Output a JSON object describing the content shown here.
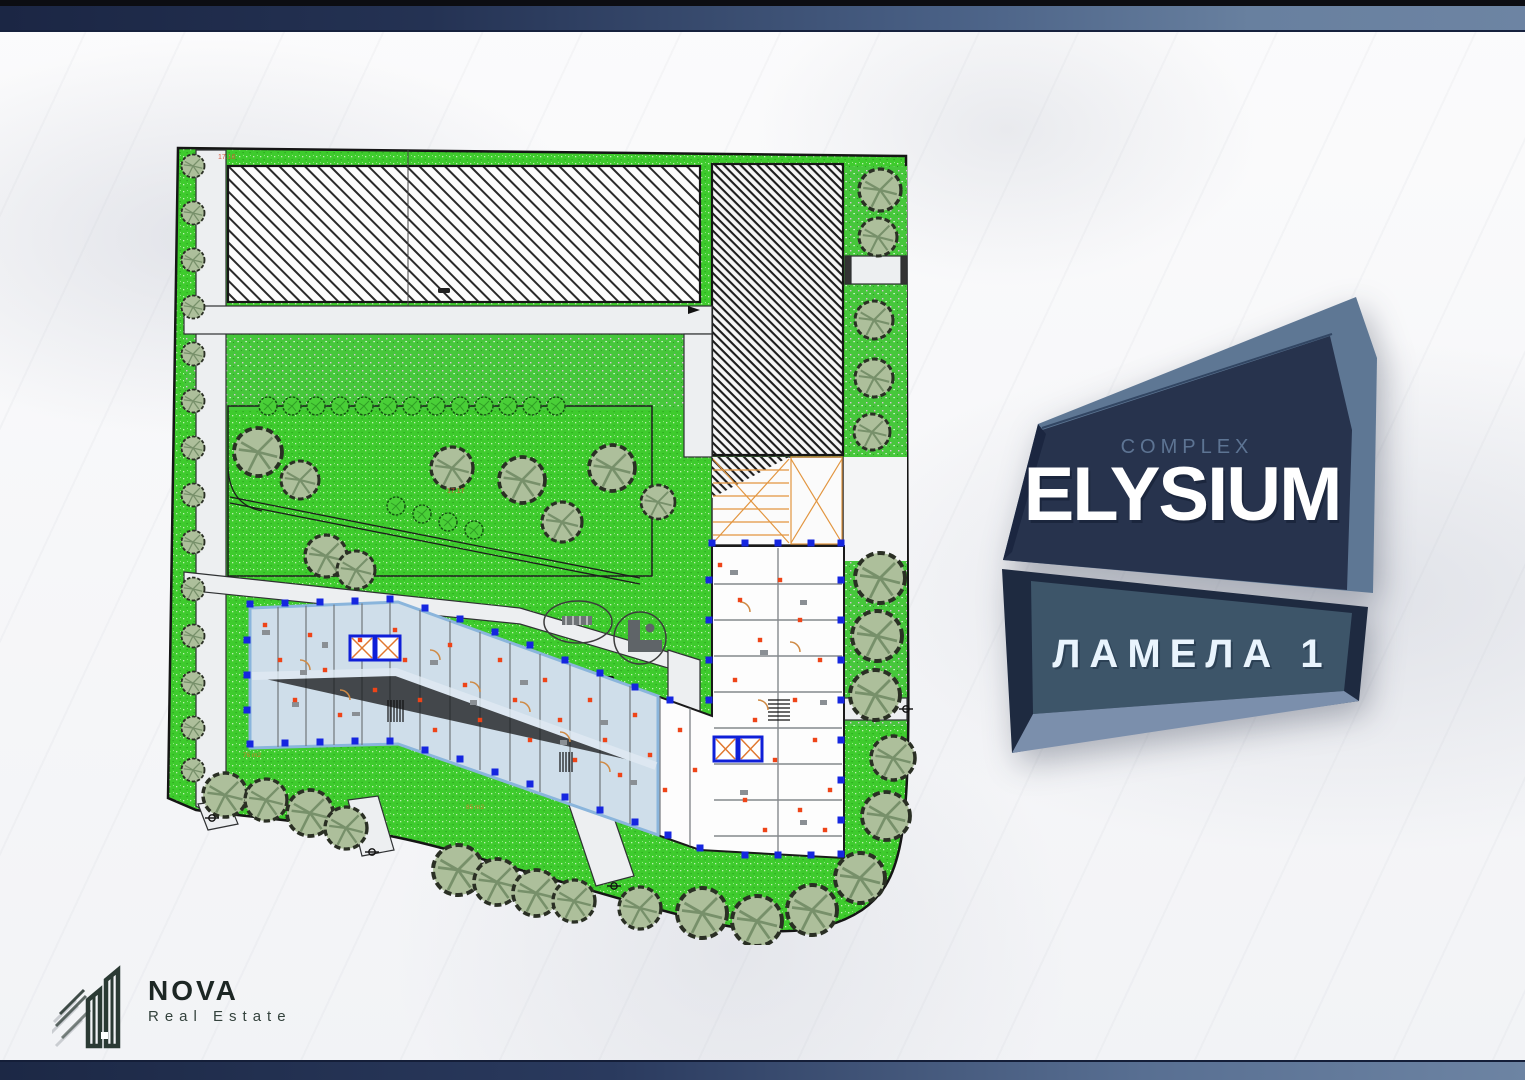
{
  "badge": {
    "kicker": "COMPLEX",
    "title": "ELYSIUM",
    "sublabel": "ЛАМЕЛА 1"
  },
  "logo": {
    "name": "NOVA",
    "tagline": "Real Estate"
  },
  "plan": {
    "labels": [
      {
        "text": "17.16"
      },
      {
        "text": "17.17"
      },
      {
        "text": "76 m2"
      },
      {
        "text": "85 m2"
      }
    ]
  },
  "colors": {
    "accent_navy": "#1e2a45",
    "accent_steel": "#6d83a4",
    "badge_face": "#27334d",
    "badge_panel": "#3d5569",
    "grass_green": "#3ecb2d",
    "highlight_blue": "#cfdeea",
    "marker_blue": "#1526e0",
    "marker_red": "#ee4418",
    "door_orange": "#d58b3f"
  }
}
